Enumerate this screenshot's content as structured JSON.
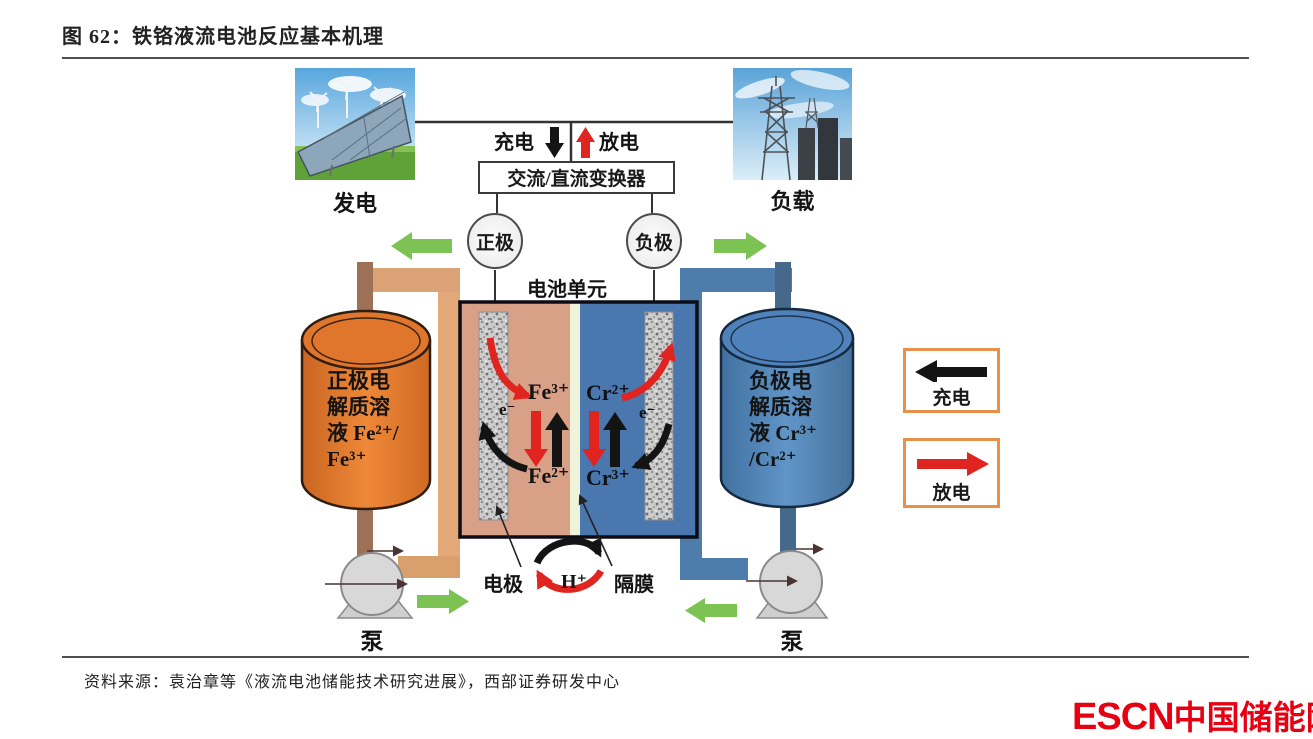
{
  "title": "图 62：铁铬液流电池反应基本机理",
  "source": "资料来源：袁治章等《液流电池储能技术研究进展》，西部证券研发中心",
  "logo": {
    "name": "ESCN",
    "suffix": "中国储能网"
  },
  "power_row": {
    "generation_label": "发电",
    "load_label": "负载",
    "charge_label": "充电",
    "discharge_label": "放电",
    "converter_label": "交流/直流变换器"
  },
  "terminals": {
    "positive": "正极",
    "negative": "负极"
  },
  "cell": {
    "title": "电池单元",
    "fe3": "Fe³⁺",
    "fe2": "Fe²⁺",
    "cr2": "Cr²⁺",
    "cr3": "Cr³⁺",
    "electron_left": "e⁻",
    "electron_right": "e⁻",
    "proton": "H⁺",
    "electrode_label": "电极",
    "membrane_label": "隔膜"
  },
  "tanks": {
    "left": {
      "lines": [
        "正极电",
        "解质溶",
        "液 Fe²⁺/",
        "Fe³⁺"
      ]
    },
    "right": {
      "lines": [
        "负极电",
        "解质溶",
        "液 Cr³⁺",
        "/Cr²⁺"
      ]
    }
  },
  "pumps": {
    "left_label": "泵",
    "right_label": "泵"
  },
  "legend": {
    "charge": "充电",
    "discharge": "放电"
  },
  "colors": {
    "tank_positive": "#e0752c",
    "tank_negative": "#4f82ba",
    "cell_positive_half": "#d8a187",
    "cell_negative_half": "#4a77ad",
    "membrane": "#eef3da",
    "charge_arrow_black": "#141414",
    "discharge_arrow_red": "#e02420",
    "flow_arrow_green": "#7dc354",
    "legend_border": "#e8914d",
    "logo_red": "#e60012"
  }
}
